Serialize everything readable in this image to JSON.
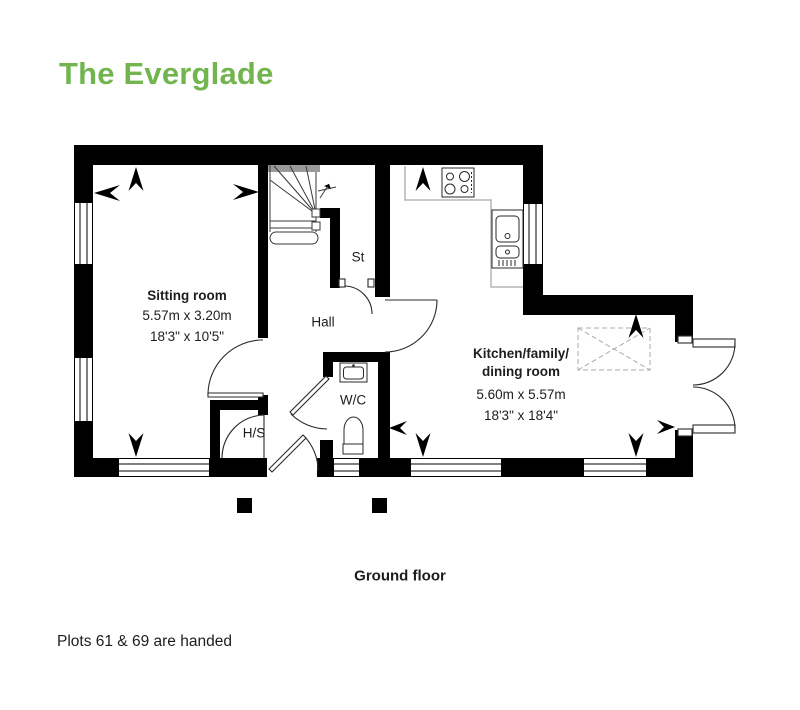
{
  "title": "The Everglade",
  "caption": "Ground floor",
  "footnote": "Plots 61 & 69 are handed",
  "colors": {
    "accent_green": "#72b54f",
    "text_dark": "#1d1d1b",
    "wall_black": "#000000"
  },
  "rooms": {
    "sitting": {
      "name": "Sitting room",
      "metric": "5.57m x 3.20m",
      "imperial": "18'3\" x 10'5\""
    },
    "kitchen": {
      "name_line1": "Kitchen/family/",
      "name_line2": "dining room",
      "metric": "5.60m x 5.57m",
      "imperial": "18'3\" x 18'4\""
    },
    "hall": {
      "name": "Hall"
    },
    "store": {
      "name": "St"
    },
    "wc": {
      "name": "W/C"
    },
    "hs": {
      "name": "H/S"
    }
  }
}
